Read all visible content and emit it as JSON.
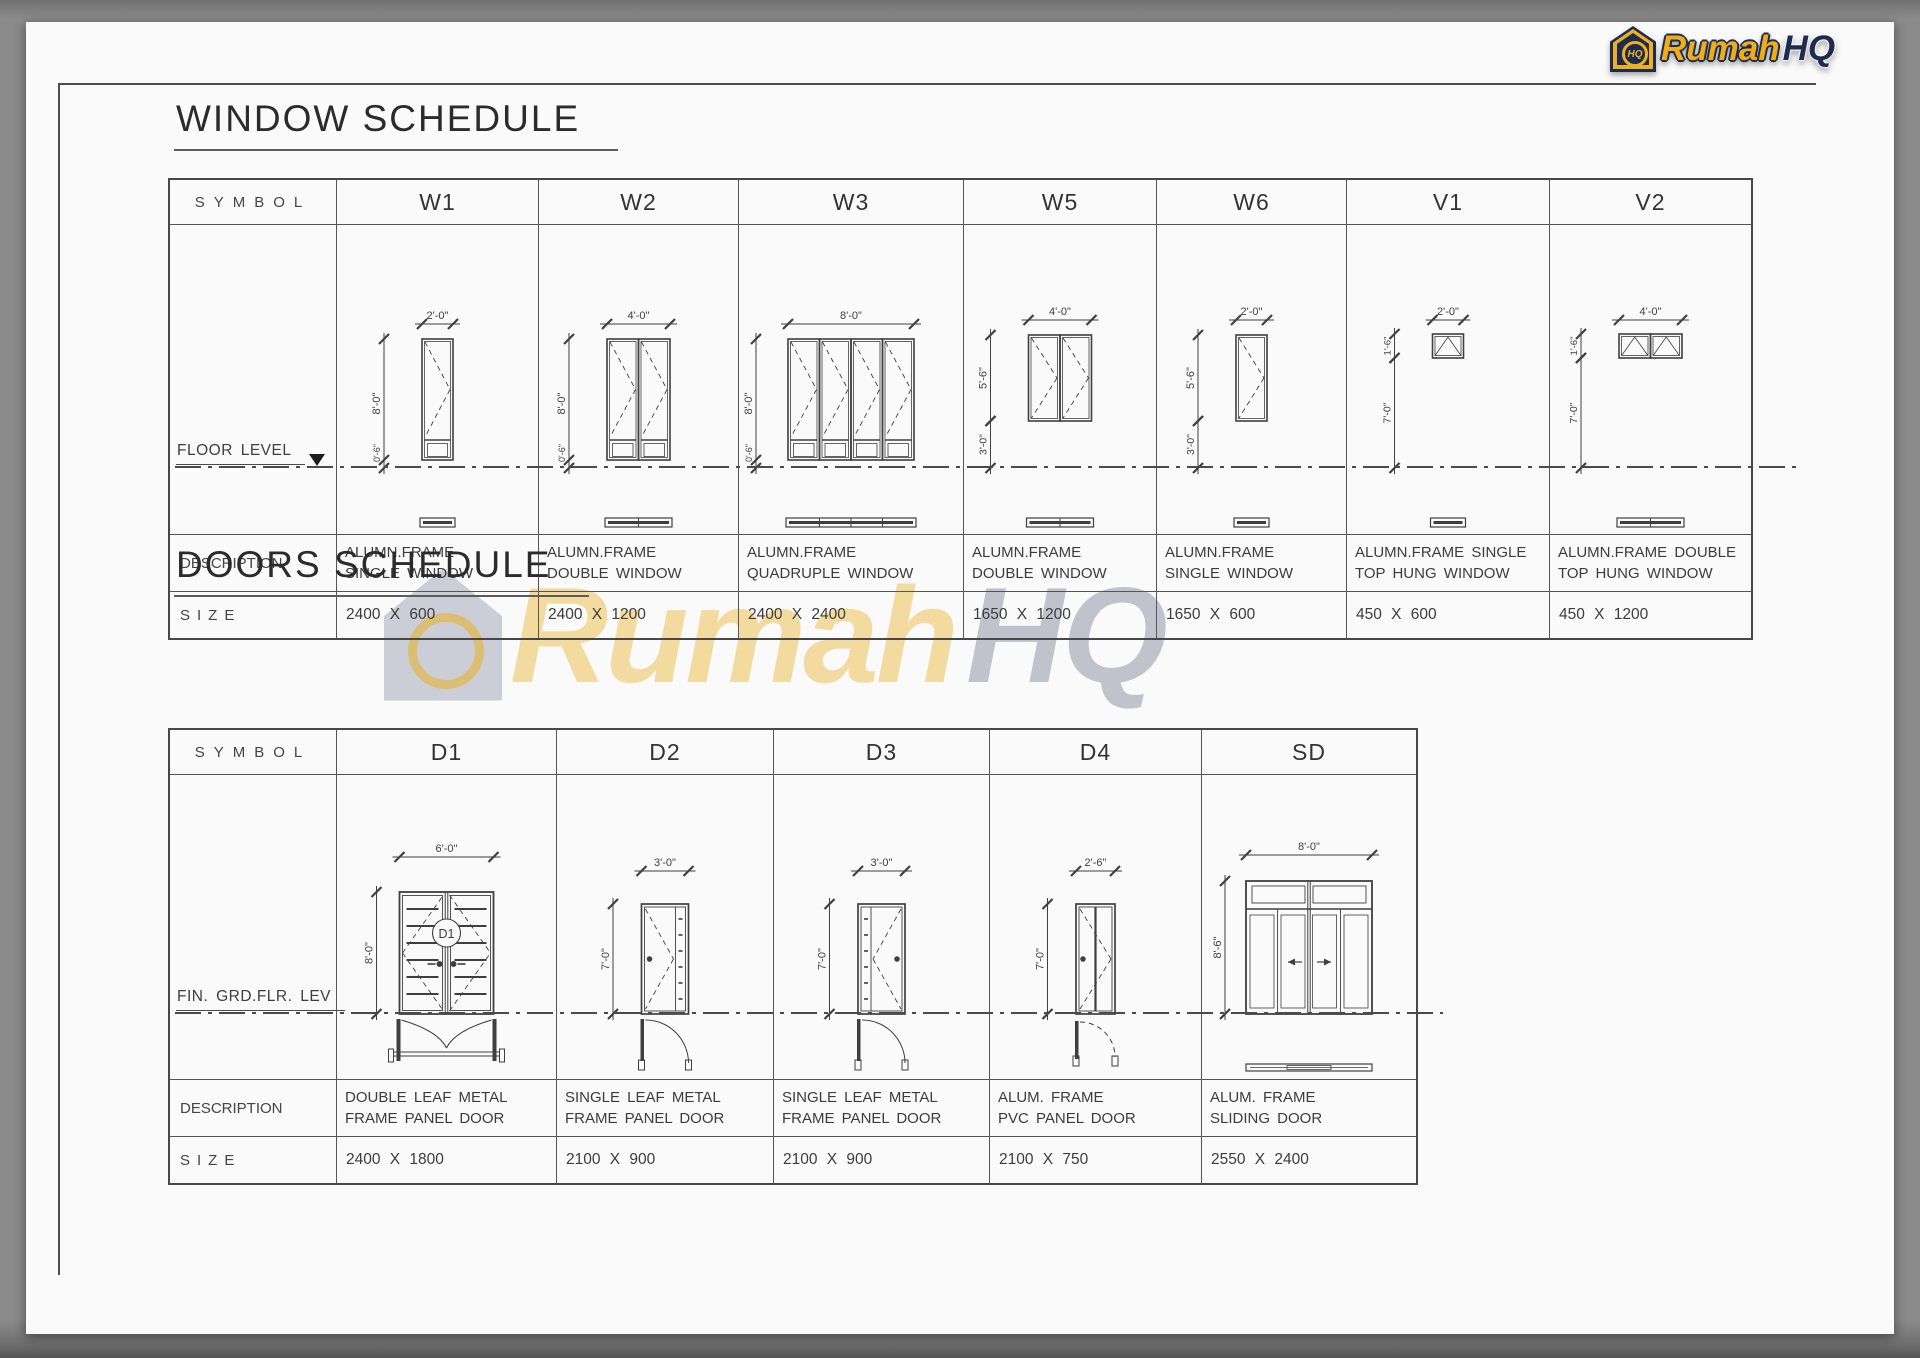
{
  "logo": {
    "brand_part1": "Rumah",
    "brand_part2": "HQ",
    "icon_text": "HQ"
  },
  "window_schedule": {
    "title": "WINDOW SCHEDULE",
    "row_labels": {
      "symbol": "SYMBOL",
      "floor": "FLOOR LEVEL",
      "description": "DESCRIPTION",
      "size": "SIZE"
    },
    "columns": [
      {
        "symbol": "W1",
        "description": "ALUMN.FRAME\nSINGLE WINDOW",
        "size": "2400 X 600",
        "dims": {
          "width": "2'-0\"",
          "height": "8'-0\"",
          "bottom": "0'-6\""
        }
      },
      {
        "symbol": "W2",
        "description": "ALUMN.FRAME\nDOUBLE WINDOW",
        "size": "2400 X 1200",
        "dims": {
          "width": "4'-0\"",
          "height": "8'-0\"",
          "bottom": "0'-6\""
        }
      },
      {
        "symbol": "W3",
        "description": "ALUMN.FRAME\nQUADRUPLE WINDOW",
        "size": "2400 X 2400",
        "dims": {
          "width": "8'-0\"",
          "height": "8'-0\"",
          "bottom": "0'-6\""
        }
      },
      {
        "symbol": "W5",
        "description": "ALUMN.FRAME\nDOUBLE WINDOW",
        "size": "1650 X 1200",
        "dims": {
          "width": "4'-0\"",
          "height": "5'-6\"",
          "bottom": "3'-0\""
        }
      },
      {
        "symbol": "W6",
        "description": "ALUMN.FRAME\nSINGLE WINDOW",
        "size": "1650 X 600",
        "dims": {
          "width": "2'-0\"",
          "height": "5'-6\"",
          "bottom": "3'-0\""
        }
      },
      {
        "symbol": "V1",
        "description": "ALUMN.FRAME SINGLE\nTOP HUNG WINDOW",
        "size": "450 X 600",
        "dims": {
          "width": "2'-0\"",
          "height": "1'-6\"",
          "bottom": "7'-0\""
        }
      },
      {
        "symbol": "V2",
        "description": "ALUMN.FRAME DOUBLE\nTOP HUNG WINDOW",
        "size": "450 X 1200",
        "dims": {
          "width": "4'-0\"",
          "height": "1'-6\"",
          "bottom": "7'-0\""
        }
      }
    ]
  },
  "doors_schedule": {
    "title": "DOORS SCHEDULE",
    "row_labels": {
      "symbol": "SYMBOL",
      "floor": "FIN. GRD.FLR. LEV",
      "description": "DESCRIPTION",
      "size": "SIZE"
    },
    "columns": [
      {
        "symbol": "D1",
        "tag": "D1",
        "description": "DOUBLE LEAF METAL\nFRAME PANEL DOOR",
        "size": "2400 X 1800",
        "dims": {
          "width": "6'-0\"",
          "height": "8'-0\""
        }
      },
      {
        "symbol": "D2",
        "description": "SINGLE LEAF METAL\nFRAME PANEL DOOR",
        "size": "2100 X 900",
        "dims": {
          "width": "3'-0\"",
          "height": "7'-0\""
        }
      },
      {
        "symbol": "D3",
        "description": "SINGLE LEAF METAL\nFRAME PANEL DOOR",
        "size": "2100 X 900",
        "dims": {
          "width": "3'-0\"",
          "height": "7'-0\""
        }
      },
      {
        "symbol": "D4",
        "description": "ALUM. FRAME\nPVC PANEL DOOR",
        "size": "2100 X 750",
        "dims": {
          "width": "2'-6\"",
          "height": "7'-0\""
        }
      },
      {
        "symbol": "SD",
        "description": "ALUM. FRAME\nSLIDING DOOR",
        "size": "2550 X 2400",
        "dims": {
          "width": "8'-0\"",
          "height": "8'-6\""
        }
      }
    ]
  }
}
